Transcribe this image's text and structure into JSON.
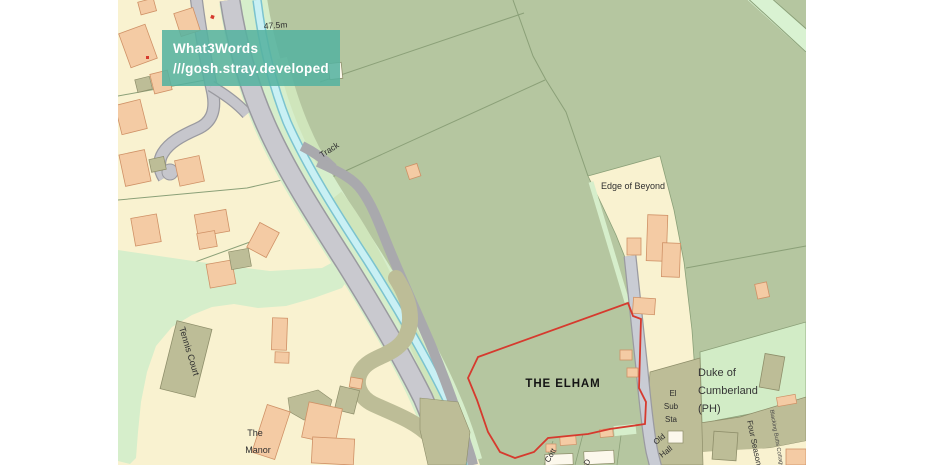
{
  "overlay": {
    "title": "What3Words",
    "address": "///gosh.stray.developed"
  },
  "map_labels": {
    "spot_height": "47.5m",
    "track": "Track",
    "edge_of_beyond": "Edge of Beyond",
    "subject_property": "THE ELHAM",
    "el_sub_sta": {
      "line1": "El",
      "line2": "Sub",
      "line3": "Sta"
    },
    "duke_of_cumberland": {
      "line1": "Duke of",
      "line2": "Cumberland",
      "line3": "(PH)"
    },
    "old_hall": {
      "line1": "Old",
      "line2": "Hall"
    },
    "tennis_court": "Tennis Court",
    "the_manor": {
      "line1": "The",
      "line2": "Manor"
    },
    "four_seasons": "Four Seasons",
    "cottage_east": "Blacking Butts Cottage",
    "cottage_partial": "Cott",
    "cottage_partial_2": "D"
  },
  "colors": {
    "badge_bg": "#55b2a0",
    "badge_text": "#ffffff",
    "boundary_red": "#d63a2e",
    "field_sage": "#b5c6a0",
    "parcel_cream": "#f9f2d0",
    "verge_mint": "#d6eecb",
    "paddock_green": "#cfe5bb",
    "khaki": "#bdbd97",
    "building_peach": "#f4cba4",
    "road_gray": "#c9c9cf",
    "stream_cyan": "#c9f0f4"
  }
}
